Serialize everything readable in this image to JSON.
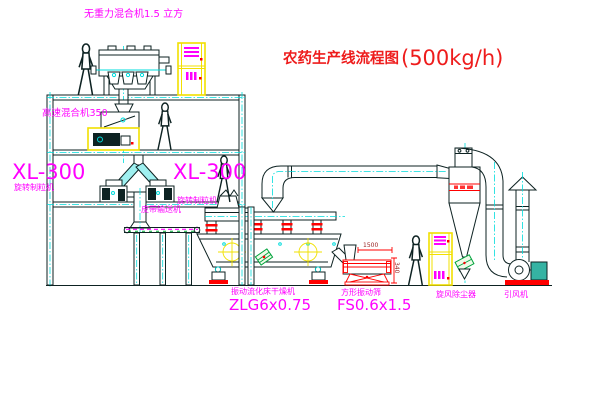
{
  "diagram": {
    "title": "农药生产线流程图",
    "title_capacity": "(500kg/h)"
  },
  "labels": {
    "gravity_mixer": "无重力混合机1.5 立方",
    "high_speed_mixer": "高速混合机350",
    "granulator_left_model": "XL-300",
    "granulator_left_name": "旋转制粒机",
    "granulator_right_model": "XL-300",
    "granulator_right_name": "旋转制粒机",
    "belt_conveyor": "皮带输送机",
    "fluid_bed_dryer_name": "振动流化床干燥机",
    "fluid_bed_dryer_model": "ZLG6x0.75",
    "vibrating_screen_name": "方形振动筛",
    "vibrating_screen_model": "FS0.6x1.5",
    "cyclone": "旋风除尘器",
    "induced_draft_fan": "引风机"
  },
  "dimensions": {
    "screen_length": "1500",
    "screen_height": "340"
  },
  "colors": {
    "label_magenta": "#ff00ff",
    "title_red": "#ee1c1c",
    "centerline_cyan": "#00dcdc",
    "cabinet_yellow": "#f2e000",
    "line_dark": "#0d2222",
    "screen_red": "#ff0000",
    "motor_green": "#00a33c",
    "fan_motor_teal": "#35b3a3"
  }
}
